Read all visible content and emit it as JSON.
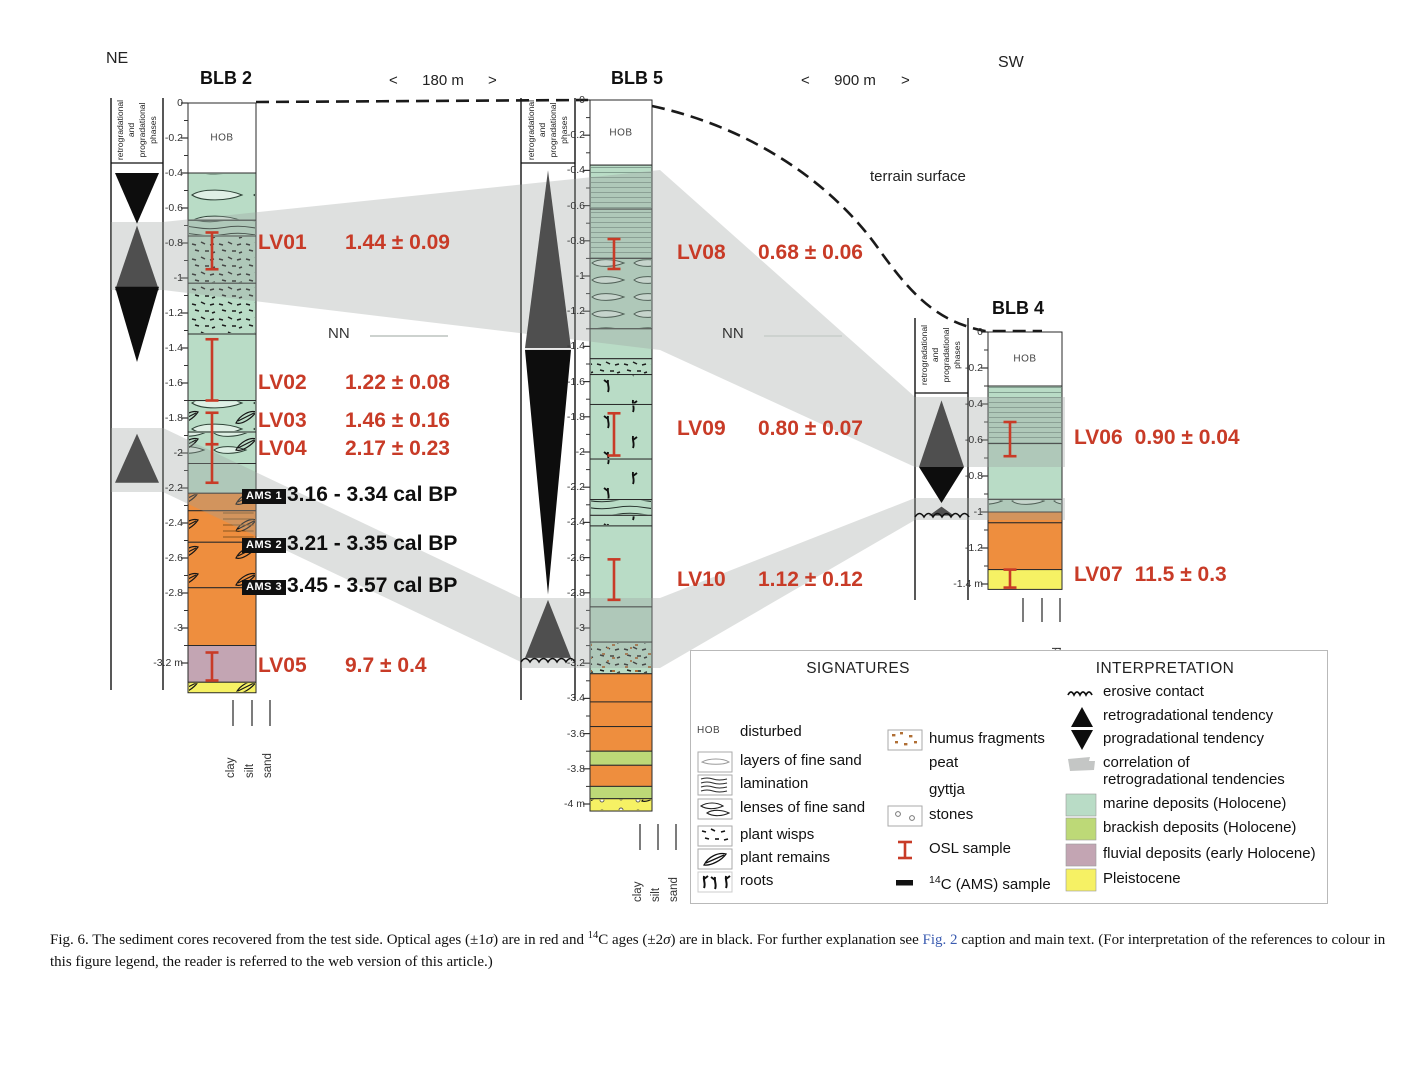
{
  "compass": {
    "left": "NE",
    "right": "SW"
  },
  "terrain_label": "terrain surface",
  "nn_label": "NN",
  "phase_axis_lines": [
    "retrogradational",
    "and",
    "progradational",
    "phases"
  ],
  "grain_labels": [
    "clay",
    "silt",
    "sand"
  ],
  "distances": [
    {
      "left_arrow": "<",
      "label": "180 m",
      "right_arrow": ">"
    },
    {
      "left_arrow": "<",
      "label": "900 m",
      "right_arrow": ">"
    }
  ],
  "colors": {
    "osl_red": "#c83b27",
    "marine": "#b9dcc6",
    "brackish": "#bdd977",
    "fluvial": "#c3a5b3",
    "gyttja": "#ee8e3e",
    "peat": "#ee8e3e",
    "pleistocene": "#f6f164",
    "disturbed": "#ffffff",
    "correlation_band": "#9aa09d"
  },
  "cores": [
    {
      "id": "BLB2",
      "title": "BLB 2",
      "tick_labels": [
        "0",
        "-0.2",
        "-0.4",
        "-0.6",
        "-0.8",
        "-1",
        "-1.2",
        "-1.4",
        "-1.6",
        "-1.8",
        "-2",
        "-2.2",
        "-2.4",
        "-2.6",
        "-2.8",
        "-3",
        "-3.2 m"
      ],
      "layers": [
        {
          "top": 0.0,
          "base": 0.4,
          "type": "disturbed",
          "textures": [],
          "label": "HOB"
        },
        {
          "top": 0.4,
          "base": 0.67,
          "type": "marine",
          "textures": [
            "lenses-big"
          ]
        },
        {
          "top": 0.67,
          "base": 0.76,
          "type": "marine",
          "textures": [
            "lam-dark"
          ]
        },
        {
          "top": 0.76,
          "base": 1.03,
          "type": "marine",
          "textures": [
            "wisps"
          ]
        },
        {
          "top": 1.03,
          "base": 1.32,
          "type": "marine",
          "textures": [
            "wisps"
          ]
        },
        {
          "top": 1.32,
          "base": 1.7,
          "type": "marine",
          "textures": []
        },
        {
          "top": 1.7,
          "base": 1.88,
          "type": "marine",
          "textures": [
            "lenses-big",
            "leaf"
          ]
        },
        {
          "top": 1.88,
          "base": 2.06,
          "type": "marine",
          "textures": [
            "lenses",
            "leaf"
          ]
        },
        {
          "top": 2.06,
          "base": 2.23,
          "type": "marine",
          "textures": []
        },
        {
          "top": 2.23,
          "base": 2.33,
          "type": "peat",
          "textures": [
            "leaf"
          ]
        },
        {
          "top": 2.33,
          "base": 2.51,
          "type": "peat",
          "textures": [
            "leaf",
            "lam-orange"
          ]
        },
        {
          "top": 2.51,
          "base": 2.77,
          "type": "peat",
          "textures": [
            "leaf"
          ]
        },
        {
          "top": 2.77,
          "base": 3.1,
          "type": "gyttja",
          "textures": []
        },
        {
          "top": 3.1,
          "base": 3.31,
          "type": "fluvial",
          "textures": []
        },
        {
          "top": 3.31,
          "base": 3.37,
          "type": "pleistocene",
          "textures": [
            "leaf"
          ]
        }
      ],
      "phases": [
        {
          "shape": "tri-down",
          "tone": "black",
          "top": 0.4,
          "base": 0.69
        },
        {
          "shape": "tri-up",
          "tone": "gray",
          "top": 0.7,
          "base": 1.07
        },
        {
          "shape": "tri-down",
          "tone": "black",
          "top": 1.05,
          "base": 1.48
        },
        {
          "shape": "tri-up",
          "tone": "gray",
          "top": 1.89,
          "base": 2.17
        }
      ],
      "samples": [
        {
          "id": "LV01",
          "age": "1.44 ± 0.09",
          "kind": "OSL",
          "bar": [
            0.74,
            0.95
          ],
          "label_d": 0.81
        },
        {
          "id": "LV02",
          "age": "1.22 ± 0.08",
          "kind": "OSL",
          "bar": [
            1.35,
            1.7
          ],
          "label_d": 1.61
        },
        {
          "id": "LV03",
          "age": "1.46 ± 0.16",
          "kind": "OSL",
          "bar": [
            1.77,
            1.95
          ],
          "label_d": 1.83
        },
        {
          "id": "LV04",
          "age": "2.17 ± 0.23",
          "kind": "OSL",
          "bar": [
            1.95,
            2.17
          ],
          "label_d": 1.99
        },
        {
          "id": "AMS 1",
          "age": "3.16 - 3.34 cal BP",
          "kind": "AMS",
          "label_d": 2.25
        },
        {
          "id": "AMS 2",
          "age": "3.21 - 3.35 cal BP",
          "kind": "AMS",
          "label_d": 2.53
        },
        {
          "id": "AMS 3",
          "age": "3.45 - 3.57 cal BP",
          "kind": "AMS",
          "label_d": 2.77
        },
        {
          "id": "LV05",
          "age": "9.7 ± 0.4",
          "kind": "OSL",
          "bar": [
            3.14,
            3.3
          ],
          "label_d": 3.23
        }
      ]
    },
    {
      "id": "BLB5",
      "title": "BLB 5",
      "tick_labels": [
        "0",
        "-0.2",
        "-0.4",
        "-0.6",
        "-0.8",
        "-1",
        "-1.2",
        "-1.4",
        "-1.6",
        "-1.8",
        "-2",
        "-2.2",
        "-2.4",
        "-2.6",
        "-2.8",
        "-3",
        "-3.2",
        "-3.4",
        "-3.6",
        "-3.8",
        "-4 m"
      ],
      "layers": [
        {
          "top": 0.0,
          "base": 0.37,
          "type": "disturbed",
          "textures": [],
          "label": "HOB"
        },
        {
          "top": 0.37,
          "base": 0.62,
          "type": "marine",
          "textures": [
            "lam-fine"
          ]
        },
        {
          "top": 0.62,
          "base": 0.9,
          "type": "marine",
          "textures": [
            "lam-fine"
          ]
        },
        {
          "top": 0.9,
          "base": 1.3,
          "type": "marine",
          "textures": [
            "lenses"
          ]
        },
        {
          "top": 1.3,
          "base": 1.47,
          "type": "marine",
          "textures": []
        },
        {
          "top": 1.47,
          "base": 1.56,
          "type": "marine",
          "textures": [
            "wisps"
          ]
        },
        {
          "top": 1.56,
          "base": 1.73,
          "type": "marine",
          "textures": [
            "roots"
          ]
        },
        {
          "top": 1.73,
          "base": 2.04,
          "type": "marine",
          "textures": [
            "roots"
          ]
        },
        {
          "top": 2.04,
          "base": 2.27,
          "type": "marine",
          "textures": [
            "roots"
          ]
        },
        {
          "top": 2.27,
          "base": 2.36,
          "type": "marine",
          "textures": [
            "lam-dark"
          ]
        },
        {
          "top": 2.36,
          "base": 2.42,
          "type": "marine",
          "textures": [
            "roots"
          ]
        },
        {
          "top": 2.42,
          "base": 2.88,
          "type": "marine",
          "textures": []
        },
        {
          "top": 2.88,
          "base": 3.08,
          "type": "marine",
          "textures": []
        },
        {
          "top": 3.08,
          "base": 3.26,
          "type": "marine",
          "textures": [
            "wisps",
            "humus"
          ]
        },
        {
          "top": 3.26,
          "base": 3.42,
          "type": "gyttja",
          "textures": []
        },
        {
          "top": 3.42,
          "base": 3.56,
          "type": "gyttja",
          "textures": []
        },
        {
          "top": 3.56,
          "base": 3.7,
          "type": "gyttja",
          "textures": []
        },
        {
          "top": 3.7,
          "base": 3.78,
          "type": "brackish",
          "textures": []
        },
        {
          "top": 3.78,
          "base": 3.9,
          "type": "gyttja",
          "textures": []
        },
        {
          "top": 3.9,
          "base": 3.97,
          "type": "brackish",
          "textures": []
        },
        {
          "top": 3.97,
          "base": 4.04,
          "type": "pleistocene",
          "textures": [
            "stones",
            "leaf"
          ]
        }
      ],
      "phases": [
        {
          "shape": "tri-up",
          "tone": "gray",
          "top": 0.4,
          "base": 1.41
        },
        {
          "shape": "tri-down",
          "tone": "black",
          "top": 1.42,
          "base": 2.81
        },
        {
          "shape": "tri-up",
          "tone": "gray",
          "top": 2.84,
          "base": 3.17
        }
      ],
      "samples": [
        {
          "id": "LV08",
          "age": "0.68 ± 0.06",
          "kind": "OSL",
          "bar": [
            0.79,
            0.96
          ],
          "label_d": 0.88
        },
        {
          "id": "LV09",
          "age": "0.80 ± 0.07",
          "kind": "OSL",
          "bar": [
            1.78,
            2.02
          ],
          "label_d": 1.88
        },
        {
          "id": "LV10",
          "age": "1.12 ± 0.12",
          "kind": "OSL",
          "bar": [
            2.61,
            2.84
          ],
          "label_d": 2.74
        }
      ]
    },
    {
      "id": "BLB4",
      "title": "BLB 4",
      "tick_labels": [
        "0",
        "-0.2",
        "-0.4",
        "-0.6",
        "-0.8",
        "-1",
        "-1.2",
        "-1.4 m"
      ],
      "layers": [
        {
          "top": 0.0,
          "base": 0.3,
          "type": "disturbed",
          "textures": [],
          "label": "HOB"
        },
        {
          "top": 0.3,
          "base": 0.62,
          "type": "marine",
          "textures": [
            "lam-fine"
          ]
        },
        {
          "top": 0.62,
          "base": 0.93,
          "type": "marine",
          "textures": []
        },
        {
          "top": 0.93,
          "base": 1.0,
          "type": "marine",
          "textures": [
            "lenses"
          ]
        },
        {
          "top": 1.0,
          "base": 1.06,
          "type": "gyttja",
          "textures": []
        },
        {
          "top": 1.06,
          "base": 1.32,
          "type": "gyttja",
          "textures": []
        },
        {
          "top": 1.32,
          "base": 1.43,
          "type": "pleistocene",
          "textures": []
        }
      ],
      "phases": [
        {
          "shape": "tri-up",
          "tone": "gray",
          "top": 0.38,
          "base": 0.75
        },
        {
          "shape": "tri-down",
          "tone": "black",
          "top": 0.75,
          "base": 0.95
        },
        {
          "shape": "tri-up",
          "tone": "gray",
          "top": 0.97,
          "base": 1.02,
          "inset": 14
        }
      ],
      "samples": [
        {
          "id": "LV06",
          "age": "0.90 ± 0.04",
          "kind": "OSL",
          "bar": [
            0.5,
            0.69
          ],
          "label_d": 0.6
        },
        {
          "id": "LV07",
          "age": "11.5 ± 0.3",
          "kind": "OSL",
          "bar": [
            1.32,
            1.42
          ],
          "label_d": 1.36
        }
      ]
    }
  ],
  "legend": {
    "title_left": "SIGNATURES",
    "title_right": "INTERPRETATION",
    "hob_text": "HOB",
    "signatures_col1": [
      {
        "icon": "hob",
        "label": "disturbed"
      },
      {
        "icon": "layers-fine-sand",
        "label": "layers of fine sand"
      },
      {
        "icon": "lamination",
        "label": "lamination"
      },
      {
        "icon": "lenses",
        "label": "lenses of fine sand"
      },
      {
        "icon": "wisps",
        "label": "plant wisps"
      },
      {
        "icon": "leaf",
        "label": "plant remains"
      },
      {
        "icon": "roots",
        "label": "roots"
      }
    ],
    "signatures_col2": [
      {
        "icon": "humus",
        "label": "humus fragments"
      },
      {
        "icon": "peat",
        "label": "peat"
      },
      {
        "icon": "gyttja",
        "label": "gyttja"
      },
      {
        "icon": "stones",
        "label": "stones"
      },
      {
        "icon": "osl",
        "label": "OSL sample"
      },
      {
        "icon": "c14",
        "label_sup": "14",
        "label_rest": "C (AMS) sample"
      }
    ],
    "interpretation": [
      {
        "icon": "erosive",
        "label": "erosive contact"
      },
      {
        "icon": "retro",
        "label": "retrogradational tendency"
      },
      {
        "icon": "prograd",
        "label": "progradational tendency"
      },
      {
        "icon": "correlation",
        "lines": [
          "correlation of",
          "retrogradational tendencies"
        ]
      },
      {
        "icon": "swatch-marine",
        "label": "marine deposits (Holocene)"
      },
      {
        "icon": "swatch-brackish",
        "label": "brackish deposits (Holocene)"
      },
      {
        "icon": "swatch-fluvial",
        "label": "fluvial deposits (early Holocene)"
      },
      {
        "icon": "swatch-pleistocene",
        "label": "Pleistocene"
      }
    ]
  },
  "caption": {
    "parts": [
      {
        "t": "Fig. 6. The sediment cores recovered from the test side. Optical ages (±1"
      },
      {
        "t": "σ",
        "s": "i"
      },
      {
        "t": ") are in red and "
      },
      {
        "t": "14",
        "s": "sup"
      },
      {
        "t": "C ages (±2"
      },
      {
        "t": "σ",
        "s": "i"
      },
      {
        "t": ") are in black. For further explanation see "
      },
      {
        "t": "Fig. 2",
        "s": "link"
      },
      {
        "t": " caption and main text. (For interpretation of the references to colour in this figure legend, the reader is referred to the web version of this article.)"
      }
    ]
  }
}
